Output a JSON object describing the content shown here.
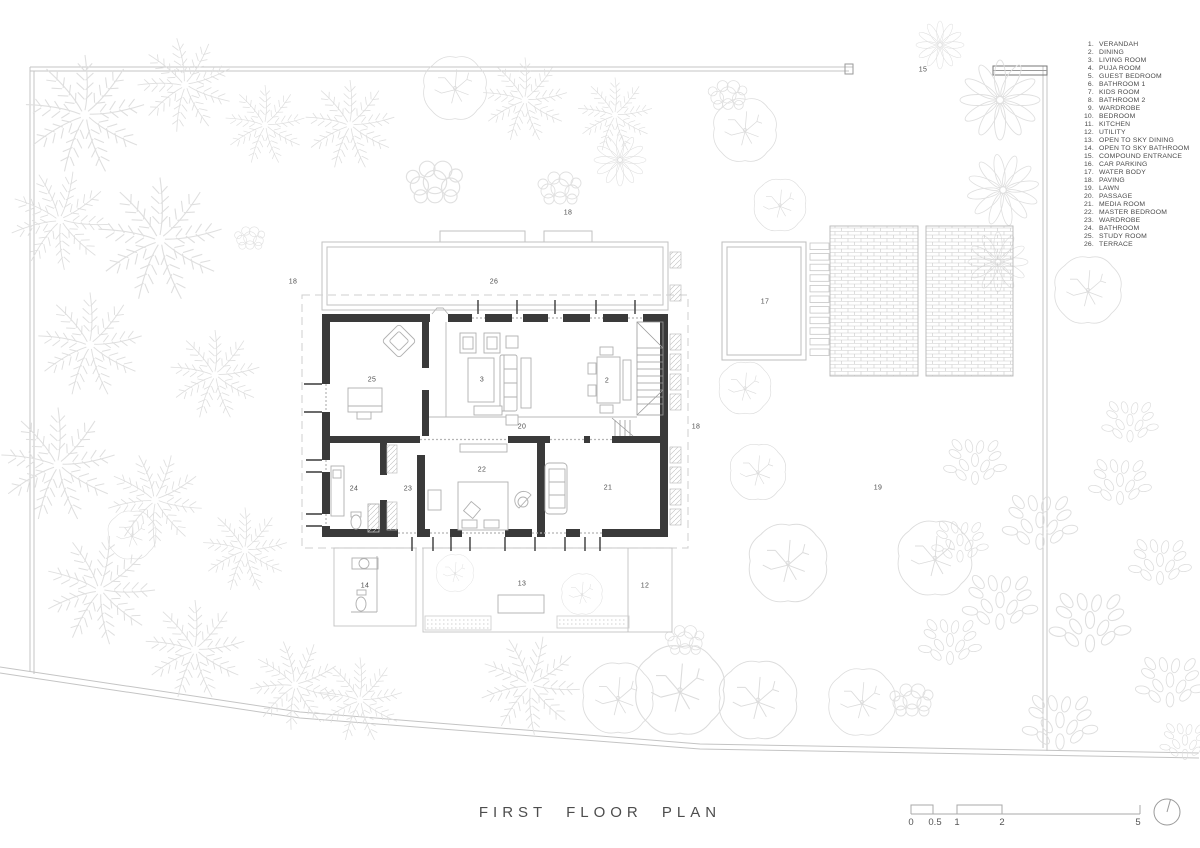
{
  "title": {
    "text": "FIRST FLOOR PLAN"
  },
  "legend": {
    "items": [
      {
        "num": "1.",
        "label": "VERANDAH"
      },
      {
        "num": "2.",
        "label": "DINING"
      },
      {
        "num": "3.",
        "label": "LIVING ROOM"
      },
      {
        "num": "4.",
        "label": "PUJA ROOM"
      },
      {
        "num": "5.",
        "label": "GUEST BEDROOM"
      },
      {
        "num": "6.",
        "label": "BATHROOM 1"
      },
      {
        "num": "7.",
        "label": "KIDS ROOM"
      },
      {
        "num": "8.",
        "label": "BATHROOM 2"
      },
      {
        "num": "9.",
        "label": "WARDROBE"
      },
      {
        "num": "10.",
        "label": "BEDROOM"
      },
      {
        "num": "11.",
        "label": "KITCHEN"
      },
      {
        "num": "12.",
        "label": "UTILITY"
      },
      {
        "num": "13.",
        "label": "OPEN TO SKY DINING"
      },
      {
        "num": "14.",
        "label": "OPEN TO SKY BATHROOM"
      },
      {
        "num": "15.",
        "label": "COMPOUND  ENTRANCE"
      },
      {
        "num": "16.",
        "label": "CAR PARKING"
      },
      {
        "num": "17.",
        "label": "WATER BODY"
      },
      {
        "num": "18.",
        "label": "PAVING"
      },
      {
        "num": "19.",
        "label": "LAWN"
      },
      {
        "num": "20.",
        "label": "PASSAGE"
      },
      {
        "num": "21.",
        "label": "MEDIA ROOM"
      },
      {
        "num": "22.",
        "label": "MASTER BEDROOM"
      },
      {
        "num": "23.",
        "label": "WARDROBE"
      },
      {
        "num": "24.",
        "label": "BATHROOM"
      },
      {
        "num": "25.",
        "label": "STUDY ROOM"
      },
      {
        "num": "26.",
        "label": "TERRACE"
      }
    ]
  },
  "plan_labels": [
    {
      "n": "15",
      "x": 923,
      "y": 70
    },
    {
      "n": "18",
      "x": 568,
      "y": 213
    },
    {
      "n": "18",
      "x": 293,
      "y": 282
    },
    {
      "n": "26",
      "x": 494,
      "y": 282
    },
    {
      "n": "17",
      "x": 765,
      "y": 302
    },
    {
      "n": "25",
      "x": 372,
      "y": 380
    },
    {
      "n": "3",
      "x": 482,
      "y": 380
    },
    {
      "n": "2",
      "x": 607,
      "y": 381
    },
    {
      "n": "20",
      "x": 522,
      "y": 427
    },
    {
      "n": "18",
      "x": 696,
      "y": 427
    },
    {
      "n": "22",
      "x": 482,
      "y": 470
    },
    {
      "n": "24",
      "x": 354,
      "y": 489
    },
    {
      "n": "23",
      "x": 408,
      "y": 489
    },
    {
      "n": "21",
      "x": 608,
      "y": 488
    },
    {
      "n": "19",
      "x": 878,
      "y": 488
    },
    {
      "n": "14",
      "x": 365,
      "y": 586
    },
    {
      "n": "13",
      "x": 522,
      "y": 584
    },
    {
      "n": "12",
      "x": 645,
      "y": 586
    }
  ],
  "scale_bar": {
    "labels": [
      {
        "text": "0",
        "x": 911
      },
      {
        "text": "0.5",
        "x": 935
      },
      {
        "text": "1",
        "x": 957
      },
      {
        "text": "2",
        "x": 1002
      },
      {
        "text": "5",
        "x": 1138
      }
    ]
  },
  "colors": {
    "wall": "#3a3a3a",
    "thin_line": "#c2c2c2",
    "furniture": "#b0b0b0",
    "vegetation": "#dfdfdf",
    "text": "#4a4a4a",
    "background": "#ffffff"
  }
}
